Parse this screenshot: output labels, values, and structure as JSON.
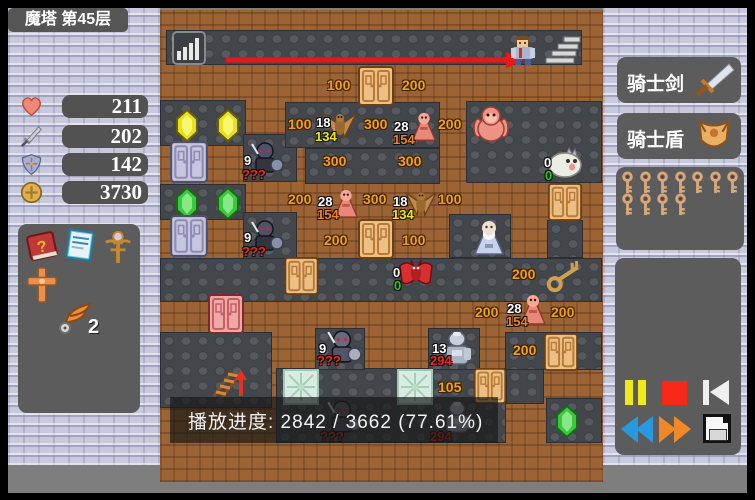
{
  "left_sidebar": {
    "floor_label": "魔塔 第45层",
    "stats": [
      {
        "name": "hp",
        "icon": "heart-icon",
        "value": "211"
      },
      {
        "name": "attack",
        "icon": "sword-icon",
        "value": "202"
      },
      {
        "name": "defense",
        "icon": "shield-icon",
        "value": "142"
      },
      {
        "name": "gold",
        "icon": "coin-icon",
        "value": "3730"
      }
    ],
    "items": [
      {
        "icon": "monster-book-icon"
      },
      {
        "icon": "notebook-icon"
      },
      {
        "icon": "scepter-icon"
      },
      {
        "icon": "cross-icon"
      },
      {
        "icon": "feather-icon",
        "count": "2"
      }
    ]
  },
  "right_sidebar": {
    "equipment": [
      {
        "label": "骑士剑",
        "icon": "sword-icon"
      },
      {
        "label": "骑士盾",
        "icon": "shield-icon"
      }
    ],
    "keys": {
      "type": "yellow-key",
      "count": 11,
      "rows": [
        7,
        4
      ]
    },
    "playback": [
      {
        "name": "pause",
        "color": "#f0e818"
      },
      {
        "name": "stop",
        "color": "#f82818"
      },
      {
        "name": "skip-to-start",
        "color": "#f0f0f0"
      },
      {
        "name": "rewind",
        "color": "#2898e0"
      },
      {
        "name": "fast-forward",
        "color": "#f08828"
      },
      {
        "name": "save",
        "color": "#f8f8f8"
      }
    ]
  },
  "progress": {
    "label": "播放进度",
    "current": "2842",
    "total": "3662",
    "percent": "77.61%"
  },
  "map": {
    "overlay": {
      "text": "播放进度: 2842 / 3662 (77.61%)",
      "x": 170,
      "y": 397,
      "w": 328,
      "h": 46
    },
    "floors": [
      [
        166,
        30,
        416,
        35
      ],
      [
        160,
        100,
        86,
        46
      ],
      [
        243,
        134,
        54,
        48
      ],
      [
        466,
        101,
        136,
        82
      ],
      [
        285,
        102,
        155,
        46
      ],
      [
        305,
        148,
        135,
        36
      ],
      [
        160,
        184,
        86,
        36
      ],
      [
        243,
        212,
        54,
        48
      ],
      [
        160,
        258,
        442,
        44
      ],
      [
        449,
        214,
        62,
        44
      ],
      [
        547,
        220,
        36,
        38
      ],
      [
        160,
        332,
        112,
        76
      ],
      [
        276,
        368,
        230,
        75
      ],
      [
        506,
        368,
        38,
        36
      ],
      [
        505,
        332,
        97,
        38
      ],
      [
        315,
        328,
        50,
        42
      ],
      [
        428,
        328,
        52,
        42
      ],
      [
        546,
        398,
        56,
        45
      ]
    ],
    "texts": [
      {
        "t": "100",
        "x": 327,
        "y": 77
      },
      {
        "t": "200",
        "x": 402,
        "y": 77
      },
      {
        "t": "100",
        "x": 288,
        "y": 116
      },
      {
        "t": "300",
        "x": 364,
        "y": 116
      },
      {
        "t": "200",
        "x": 438,
        "y": 116
      },
      {
        "t": "300",
        "x": 323,
        "y": 153
      },
      {
        "t": "300",
        "x": 398,
        "y": 153
      },
      {
        "t": "200",
        "x": 288,
        "y": 191
      },
      {
        "t": "300",
        "x": 363,
        "y": 191
      },
      {
        "t": "100",
        "x": 438,
        "y": 191
      },
      {
        "t": "200",
        "x": 324,
        "y": 232
      },
      {
        "t": "100",
        "x": 402,
        "y": 232
      },
      {
        "t": "200",
        "x": 512,
        "y": 266
      },
      {
        "t": "200",
        "x": 475,
        "y": 304
      },
      {
        "t": "200",
        "x": 551,
        "y": 304
      },
      {
        "t": "200",
        "x": 513,
        "y": 342
      },
      {
        "t": "105",
        "x": 438,
        "y": 379
      }
    ],
    "entities": [
      {
        "type": "stairs-up-icon",
        "x": 172,
        "y": 31,
        "w": 34,
        "h": 34
      },
      {
        "type": "arrow-right",
        "x": 224,
        "y": 52,
        "w": 300,
        "h": 16
      },
      {
        "type": "hero",
        "x": 506,
        "y": 33,
        "w": 34,
        "h": 34
      },
      {
        "type": "stairs",
        "x": 544,
        "y": 35,
        "w": 38,
        "h": 31
      },
      {
        "type": "door-orange",
        "x": 358,
        "y": 66,
        "w": 36,
        "h": 40
      },
      {
        "type": "gem-yellow",
        "x": 176,
        "y": 109,
        "w": 22,
        "h": 33
      },
      {
        "type": "gem-yellow",
        "x": 217,
        "y": 109,
        "w": 22,
        "h": 33
      },
      {
        "type": "monster-moth",
        "x": 322,
        "y": 108,
        "w": 36,
        "h": 36,
        "labels": [
          {
            "t": "18",
            "c": "w",
            "dx": -6,
            "dy": 8
          },
          {
            "t": "134",
            "c": "y",
            "dx": -7,
            "dy": 22
          }
        ]
      },
      {
        "type": "monster-priest",
        "x": 408,
        "y": 110,
        "w": 32,
        "h": 34,
        "labels": [
          {
            "t": "28",
            "c": "w",
            "dx": -14,
            "dy": 10
          },
          {
            "t": "154",
            "c": "o2",
            "dx": -15,
            "dy": 23
          }
        ]
      },
      {
        "type": "monster-ape",
        "x": 473,
        "y": 104,
        "w": 36,
        "h": 39
      },
      {
        "type": "monster-darkknight",
        "x": 248,
        "y": 140,
        "w": 36,
        "h": 36,
        "labels": [
          {
            "t": "9",
            "c": "w",
            "dx": -4,
            "dy": 14
          },
          {
            "t": "???",
            "c": "r",
            "dx": -6,
            "dy": 28
          }
        ]
      },
      {
        "type": "monster-slime",
        "x": 546,
        "y": 146,
        "w": 36,
        "h": 32,
        "labels": [
          {
            "t": "0",
            "c": "w",
            "dx": -2,
            "dy": 10
          },
          {
            "t": "0",
            "c": "g",
            "dx": -1,
            "dy": 23
          }
        ]
      },
      {
        "type": "door-orange",
        "x": 547,
        "y": 183,
        "w": 36,
        "h": 38
      },
      {
        "type": "gem-green",
        "x": 176,
        "y": 187,
        "w": 22,
        "h": 33
      },
      {
        "type": "gem-green",
        "x": 217,
        "y": 187,
        "w": 22,
        "h": 33
      },
      {
        "type": "monster-priest",
        "x": 331,
        "y": 186,
        "w": 30,
        "h": 36,
        "labels": [
          {
            "t": "28",
            "c": "w",
            "dx": -13,
            "dy": 9
          },
          {
            "t": "154",
            "c": "o2",
            "dx": -14,
            "dy": 22
          }
        ]
      },
      {
        "type": "monster-moth",
        "x": 404,
        "y": 186,
        "w": 34,
        "h": 36,
        "labels": [
          {
            "t": "18",
            "c": "w",
            "dx": -11,
            "dy": 9
          },
          {
            "t": "134",
            "c": "y",
            "dx": -12,
            "dy": 22
          }
        ]
      },
      {
        "type": "door-blue",
        "x": 170,
        "y": 141,
        "w": 38,
        "h": 42
      },
      {
        "type": "door-blue",
        "x": 170,
        "y": 215,
        "w": 38,
        "h": 42
      },
      {
        "type": "monster-darkknight",
        "x": 248,
        "y": 218,
        "w": 36,
        "h": 36,
        "labels": [
          {
            "t": "9",
            "c": "w",
            "dx": -4,
            "dy": 13
          },
          {
            "t": "???",
            "c": "r",
            "dx": -6,
            "dy": 27
          }
        ]
      },
      {
        "type": "door-orange",
        "x": 358,
        "y": 219,
        "w": 36,
        "h": 40
      },
      {
        "type": "monster-wizard",
        "x": 470,
        "y": 218,
        "w": 38,
        "h": 40
      },
      {
        "type": "door-orange",
        "x": 283,
        "y": 257,
        "w": 37,
        "h": 38
      },
      {
        "type": "monster-redbat",
        "x": 398,
        "y": 258,
        "w": 36,
        "h": 33,
        "labels": [
          {
            "t": "0",
            "c": "w",
            "dx": -5,
            "dy": 8
          },
          {
            "t": "0",
            "c": "g",
            "dx": -4,
            "dy": 21
          }
        ]
      },
      {
        "type": "key-gold",
        "x": 544,
        "y": 261,
        "w": 40,
        "h": 31
      },
      {
        "type": "door-red",
        "x": 207,
        "y": 294,
        "w": 38,
        "h": 40
      },
      {
        "type": "monster-priest",
        "x": 517,
        "y": 292,
        "w": 32,
        "h": 36,
        "labels": [
          {
            "t": "28",
            "c": "w",
            "dx": -10,
            "dy": 10
          },
          {
            "t": "154",
            "c": "o2",
            "dx": -11,
            "dy": 23
          }
        ]
      },
      {
        "type": "monster-grayknight",
        "x": 324,
        "y": 328,
        "w": 38,
        "h": 38,
        "labels": [
          {
            "t": "9",
            "c": "w",
            "dx": -5,
            "dy": 14
          },
          {
            "t": "???",
            "c": "r",
            "dx": -7,
            "dy": 26
          }
        ]
      },
      {
        "type": "monster-silverknight",
        "x": 440,
        "y": 330,
        "w": 34,
        "h": 38,
        "labels": [
          {
            "t": "13",
            "c": "w",
            "dx": -8,
            "dy": 12
          },
          {
            "t": "294",
            "c": "r",
            "dx": -10,
            "dy": 24
          }
        ]
      },
      {
        "type": "door-orange",
        "x": 543,
        "y": 333,
        "w": 36,
        "h": 38
      },
      {
        "type": "stairs-down",
        "x": 206,
        "y": 366,
        "w": 40,
        "h": 34
      },
      {
        "type": "arrow-up-small",
        "x": 234,
        "y": 370,
        "w": 14,
        "h": 28
      },
      {
        "type": "ice-tile",
        "x": 283,
        "y": 369,
        "w": 36,
        "h": 36
      },
      {
        "type": "ice-tile",
        "x": 397,
        "y": 369,
        "w": 36,
        "h": 36
      },
      {
        "type": "door-orange",
        "x": 473,
        "y": 368,
        "w": 34,
        "h": 36
      },
      {
        "type": "monster-grayknight",
        "x": 324,
        "y": 398,
        "w": 38,
        "h": 38,
        "dim": true,
        "labels": [
          {
            "t": "???",
            "c": "r",
            "dx": -4,
            "dy": 32
          }
        ]
      },
      {
        "type": "monster-silverknight",
        "x": 440,
        "y": 400,
        "w": 34,
        "h": 36,
        "dim": true,
        "labels": [
          {
            "t": "294",
            "c": "r",
            "dx": -10,
            "dy": 30
          }
        ]
      },
      {
        "type": "gem-green",
        "x": 556,
        "y": 405,
        "w": 22,
        "h": 33
      }
    ]
  }
}
